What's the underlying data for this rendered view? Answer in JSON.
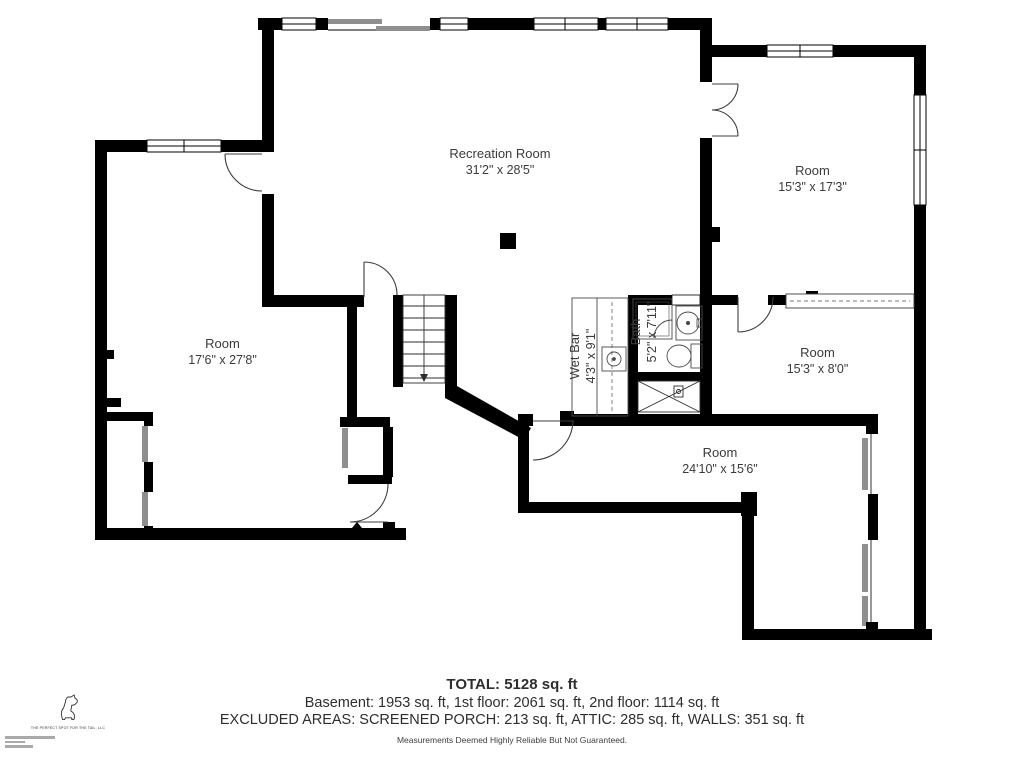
{
  "plan": {
    "rooms": [
      {
        "name": "Recreation Room",
        "dimensions": "31'2\" x 28'5\""
      },
      {
        "name": "Room",
        "dimensions": "15'3\" x 17'3\""
      },
      {
        "name": "Room",
        "dimensions": "17'6\" x 27'8\""
      },
      {
        "name": "Wet Bar",
        "dimensions": "4'3\" x 9'1\""
      },
      {
        "name": "Bath",
        "dimensions": "5'2\" x 7'11\""
      },
      {
        "name": "Room",
        "dimensions": "15'3\" x 8'0\""
      },
      {
        "name": "Room",
        "dimensions": "24'10\" x 15'6\""
      }
    ],
    "colors": {
      "wall": "#000000",
      "door_panel": "#9e9e9e",
      "sliding_door": "#8f8f8f",
      "arc": "#444444"
    }
  },
  "footer": {
    "total": "TOTAL: 5128 sq. ft",
    "floors": "Basement: 1953 sq. ft, 1st floor: 2061 sq. ft, 2nd floor: 1114 sq. ft",
    "excluded": "EXCLUDED AREAS: SCREENED PORCH: 213 sq. ft, ATTIC: 285 sq. ft, WALLS: 351 sq. ft",
    "disclaimer": "Measurements Deemed Highly Reliable But Not Guaranteed."
  },
  "logo": {
    "company": "THE PERFECT SPOT FOR THE TAIL, LLC"
  }
}
